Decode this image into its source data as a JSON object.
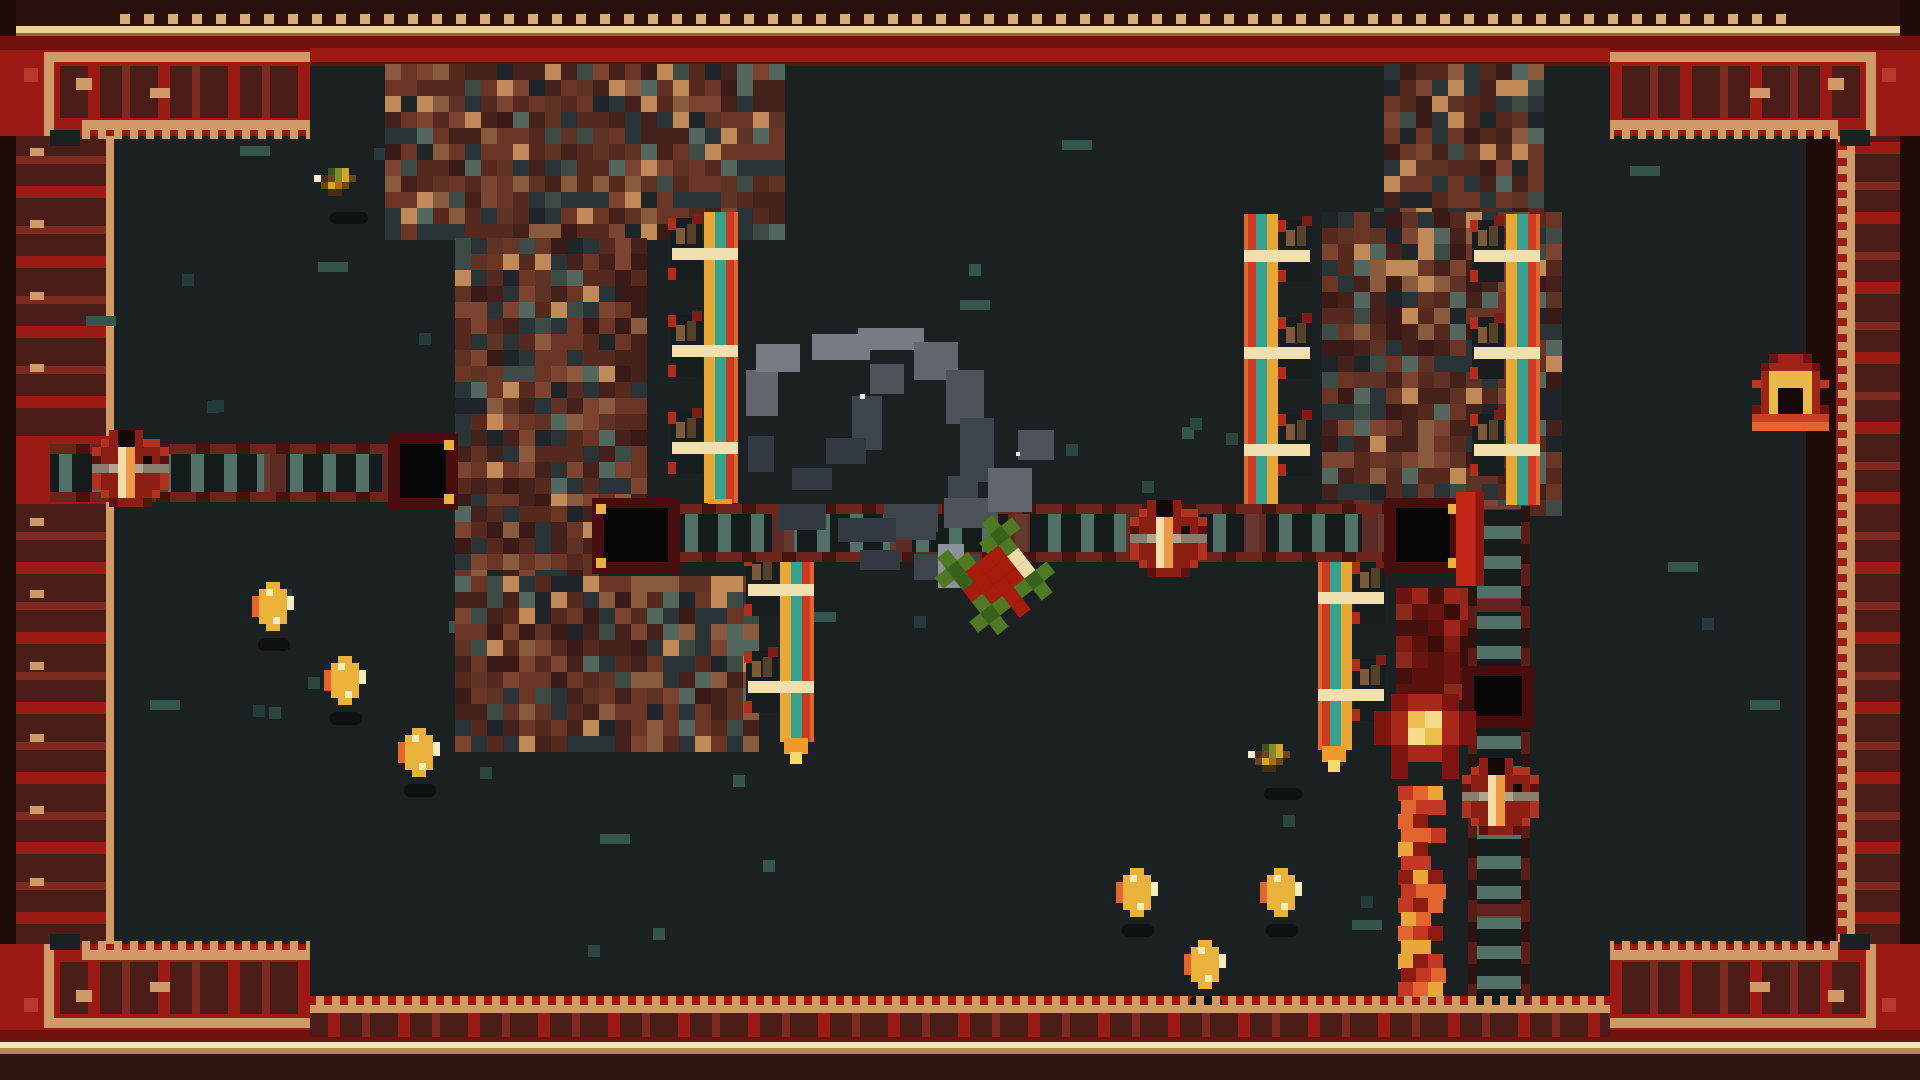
{
  "app": {
    "type": "retro pixel-art dungeon action game scene",
    "visible_text": "none"
  },
  "palette": {
    "play_background": "#1b2023",
    "border_red": "#9c1a14",
    "border_dark_red": "#6f120d",
    "border_maroon": "#4a1d18",
    "border_tan": "#cf9a66",
    "border_gold": "#ecd092",
    "border_gold_dark": "#8a6a3a",
    "border_outer_dark": "#2a100c",
    "border_dot": "#d8ac74",
    "inner_line": "#5c100c",
    "accent_red_square": "#b8392c",
    "brick_rust": "#6b3526",
    "brick_teal": "#53675e",
    "track_teal": "#52706a",
    "track_maroon": "#6e241a",
    "tile_frame": "#4a0d0d",
    "tile_black": "#060606",
    "tile_gold_pixel": "#e9b23c",
    "pillar_red": "#c22718",
    "coin_gold": "#eab13b",
    "coin_orange": "#e2642f",
    "coin_cream": "#f6ecc2",
    "flame_red": "#c33822",
    "flame_orange": "#e2642f",
    "flame_yellow": "#eaa63b",
    "pot_red": "#8c1f14",
    "pot_cream": "#f6dca8",
    "pot_gray": "#887c6e",
    "player_green": "#4f7a23",
    "player_red": "#a81c0e",
    "player_cream": "#eedca8",
    "ribbon_yellow": "#e8a838",
    "ribbon_teal": "#36a18c",
    "ribbon_red": "#cc3a24",
    "cream_bar": "#f2dfae",
    "smoke_grays": [
      "#777c83",
      "#62676e",
      "#4d5359",
      "#3e444b",
      "#333940",
      "#8d9298",
      "#e8e8e8"
    ],
    "speckle_teals": [
      "#2c463f",
      "#35564c",
      "#253a3b"
    ]
  },
  "scene": {
    "width": 1920,
    "height": 1080,
    "structures": [
      {
        "name": "brick-slab-top-left",
        "x": 385,
        "y": 64,
        "w": 385,
        "h": 176,
        "variant": "brick"
      },
      {
        "name": "brick-column-left",
        "x": 455,
        "y": 238,
        "w": 188,
        "h": 270,
        "variant": "brick"
      },
      {
        "name": "brick-ledge-left",
        "x": 455,
        "y": 506,
        "w": 140,
        "h": 72,
        "variant": "brick"
      },
      {
        "name": "brick-block-lower-left",
        "x": 455,
        "y": 576,
        "w": 292,
        "h": 162,
        "variant": "brick"
      },
      {
        "name": "brick-column-top-right",
        "x": 1384,
        "y": 64,
        "w": 148,
        "h": 150,
        "variant": "brick"
      },
      {
        "name": "brick-block-right",
        "x": 1322,
        "y": 212,
        "w": 240,
        "h": 296,
        "variant": "brick"
      },
      {
        "name": "flame-mount",
        "x": 1396,
        "y": 588,
        "w": 72,
        "h": 112,
        "variant": "red"
      }
    ],
    "tracks": [
      {
        "name": "track-left",
        "x": 50,
        "y": 444,
        "w": 340,
        "h": 58,
        "dir": "h"
      },
      {
        "name": "track-center",
        "x": 676,
        "y": 504,
        "w": 710,
        "h": 58,
        "dir": "h"
      },
      {
        "name": "ladder-right",
        "x": 1468,
        "y": 506,
        "w": 62,
        "h": 500,
        "dir": "v"
      }
    ],
    "gap_tiles": [
      {
        "x": 388,
        "y": 434,
        "w": 70,
        "h": 76,
        "anchor": "right"
      },
      {
        "x": 592,
        "y": 498,
        "w": 88,
        "h": 76,
        "anchor": "left"
      },
      {
        "x": 1384,
        "y": 498,
        "w": 78,
        "h": 76,
        "anchor": "right"
      },
      {
        "x": 1462,
        "y": 666,
        "w": 72,
        "h": 62,
        "anchor": "none"
      }
    ],
    "pillar": {
      "x": 1456,
      "y": 492,
      "w": 28,
      "h": 94
    },
    "firecracker_strips": [
      {
        "x": 668,
        "y": 212,
        "units": 3,
        "side": "right",
        "flame": true
      },
      {
        "x": 744,
        "y": 548,
        "units": 2,
        "side": "right",
        "flame": true
      },
      {
        "x": 1244,
        "y": 214,
        "units": 3,
        "side": "left",
        "flame": false
      },
      {
        "x": 1470,
        "y": 214,
        "units": 3,
        "side": "right",
        "flame": false
      },
      {
        "x": 1318,
        "y": 556,
        "units": 2,
        "side": "left",
        "flame": true
      }
    ],
    "pots": [
      {
        "x": 92,
        "y": 430
      },
      {
        "x": 1130,
        "y": 500
      },
      {
        "x": 1462,
        "y": 758
      }
    ],
    "coins": [
      [
        252,
        582
      ],
      [
        324,
        656
      ],
      [
        398,
        728
      ],
      [
        1116,
        868
      ],
      [
        1260,
        868
      ],
      [
        1184,
        940
      ]
    ],
    "birds": [
      [
        314,
        168
      ],
      [
        1248,
        744
      ]
    ],
    "door": {
      "x": 1752,
      "y": 354
    },
    "player": {
      "x": 946,
      "y": 526,
      "rotation_deg": -38
    },
    "flame_fountain": {
      "burst_x": 1374,
      "burst_y": 694,
      "stream_x": 1398,
      "stream_y": 786,
      "stream_h": 216
    },
    "smoke": {
      "segments": [
        [
          812,
          334,
          58,
          26,
          0
        ],
        [
          858,
          328,
          66,
          22,
          0
        ],
        [
          914,
          342,
          44,
          38,
          1
        ],
        [
          946,
          370,
          38,
          54,
          2
        ],
        [
          960,
          418,
          34,
          64,
          3
        ],
        [
          948,
          476,
          30,
          46,
          3
        ],
        [
          884,
          504,
          54,
          28,
          3
        ],
        [
          838,
          518,
          58,
          24,
          4
        ],
        [
          778,
          504,
          48,
          26,
          4
        ],
        [
          746,
          370,
          32,
          46,
          1
        ],
        [
          756,
          344,
          44,
          28,
          0
        ],
        [
          748,
          436,
          26,
          36,
          4
        ],
        [
          852,
          396,
          30,
          54,
          3
        ],
        [
          870,
          364,
          34,
          30,
          2
        ],
        [
          826,
          438,
          40,
          26,
          4
        ],
        [
          896,
          518,
          40,
          22,
          3
        ],
        [
          944,
          498,
          54,
          30,
          2
        ],
        [
          988,
          468,
          44,
          44,
          1
        ],
        [
          1018,
          430,
          36,
          30,
          2
        ],
        [
          914,
          554,
          66,
          26,
          3
        ],
        [
          860,
          550,
          40,
          20,
          4
        ],
        [
          938,
          544,
          26,
          44,
          5
        ],
        [
          792,
          468,
          40,
          22,
          4
        ],
        [
          860,
          394,
          5,
          5,
          6
        ],
        [
          1016,
          452,
          4,
          4,
          6
        ]
      ]
    },
    "speckles": {
      "count": 42,
      "seed": 11,
      "size": 12
    },
    "dashes": [
      [
        86,
        316
      ],
      [
        240,
        146
      ],
      [
        318,
        262
      ],
      [
        960,
        300
      ],
      [
        1062,
        140
      ],
      [
        1630,
        166
      ],
      [
        1668,
        562
      ],
      [
        806,
        612
      ],
      [
        1352,
        920
      ],
      [
        600,
        834
      ],
      [
        150,
        700
      ],
      [
        1750,
        700
      ]
    ]
  }
}
